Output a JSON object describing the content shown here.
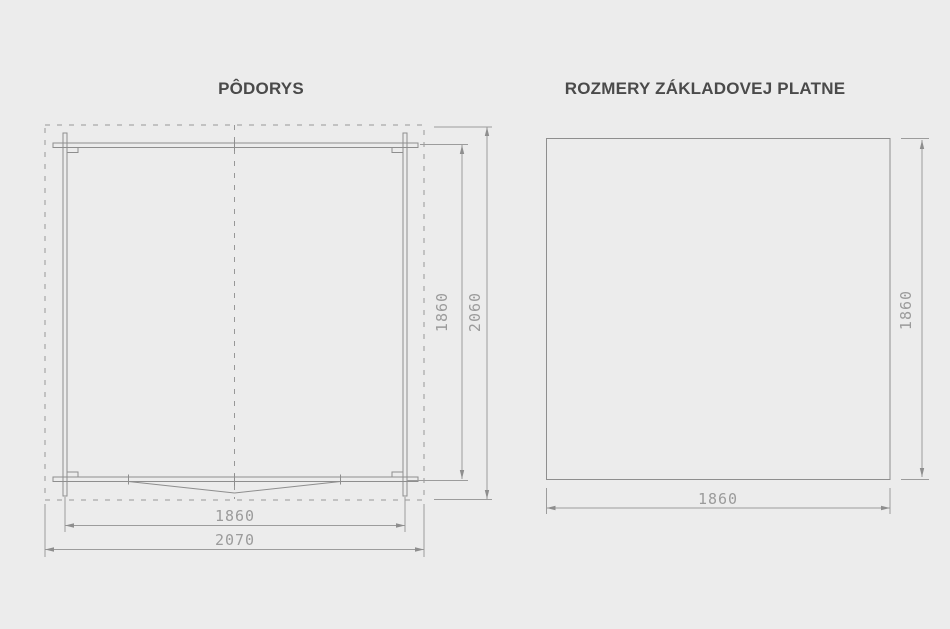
{
  "page": {
    "background_color": "#ececec"
  },
  "figures": {
    "floor_plan": {
      "title": "PÔDORYS",
      "dimensions": {
        "inner_width": "1860",
        "overall_width": "2070",
        "inner_depth": "1860",
        "overall_depth": "2060"
      }
    },
    "base_plate": {
      "title": "ROZMERY ZÁKLADOVEJ PLATNE",
      "dimensions": {
        "width": "1860",
        "height": "1860"
      }
    }
  },
  "colors": {
    "line": "#8e8e8e",
    "dimension_text": "#9b9b9b",
    "title_text": "#4a4a4a"
  }
}
